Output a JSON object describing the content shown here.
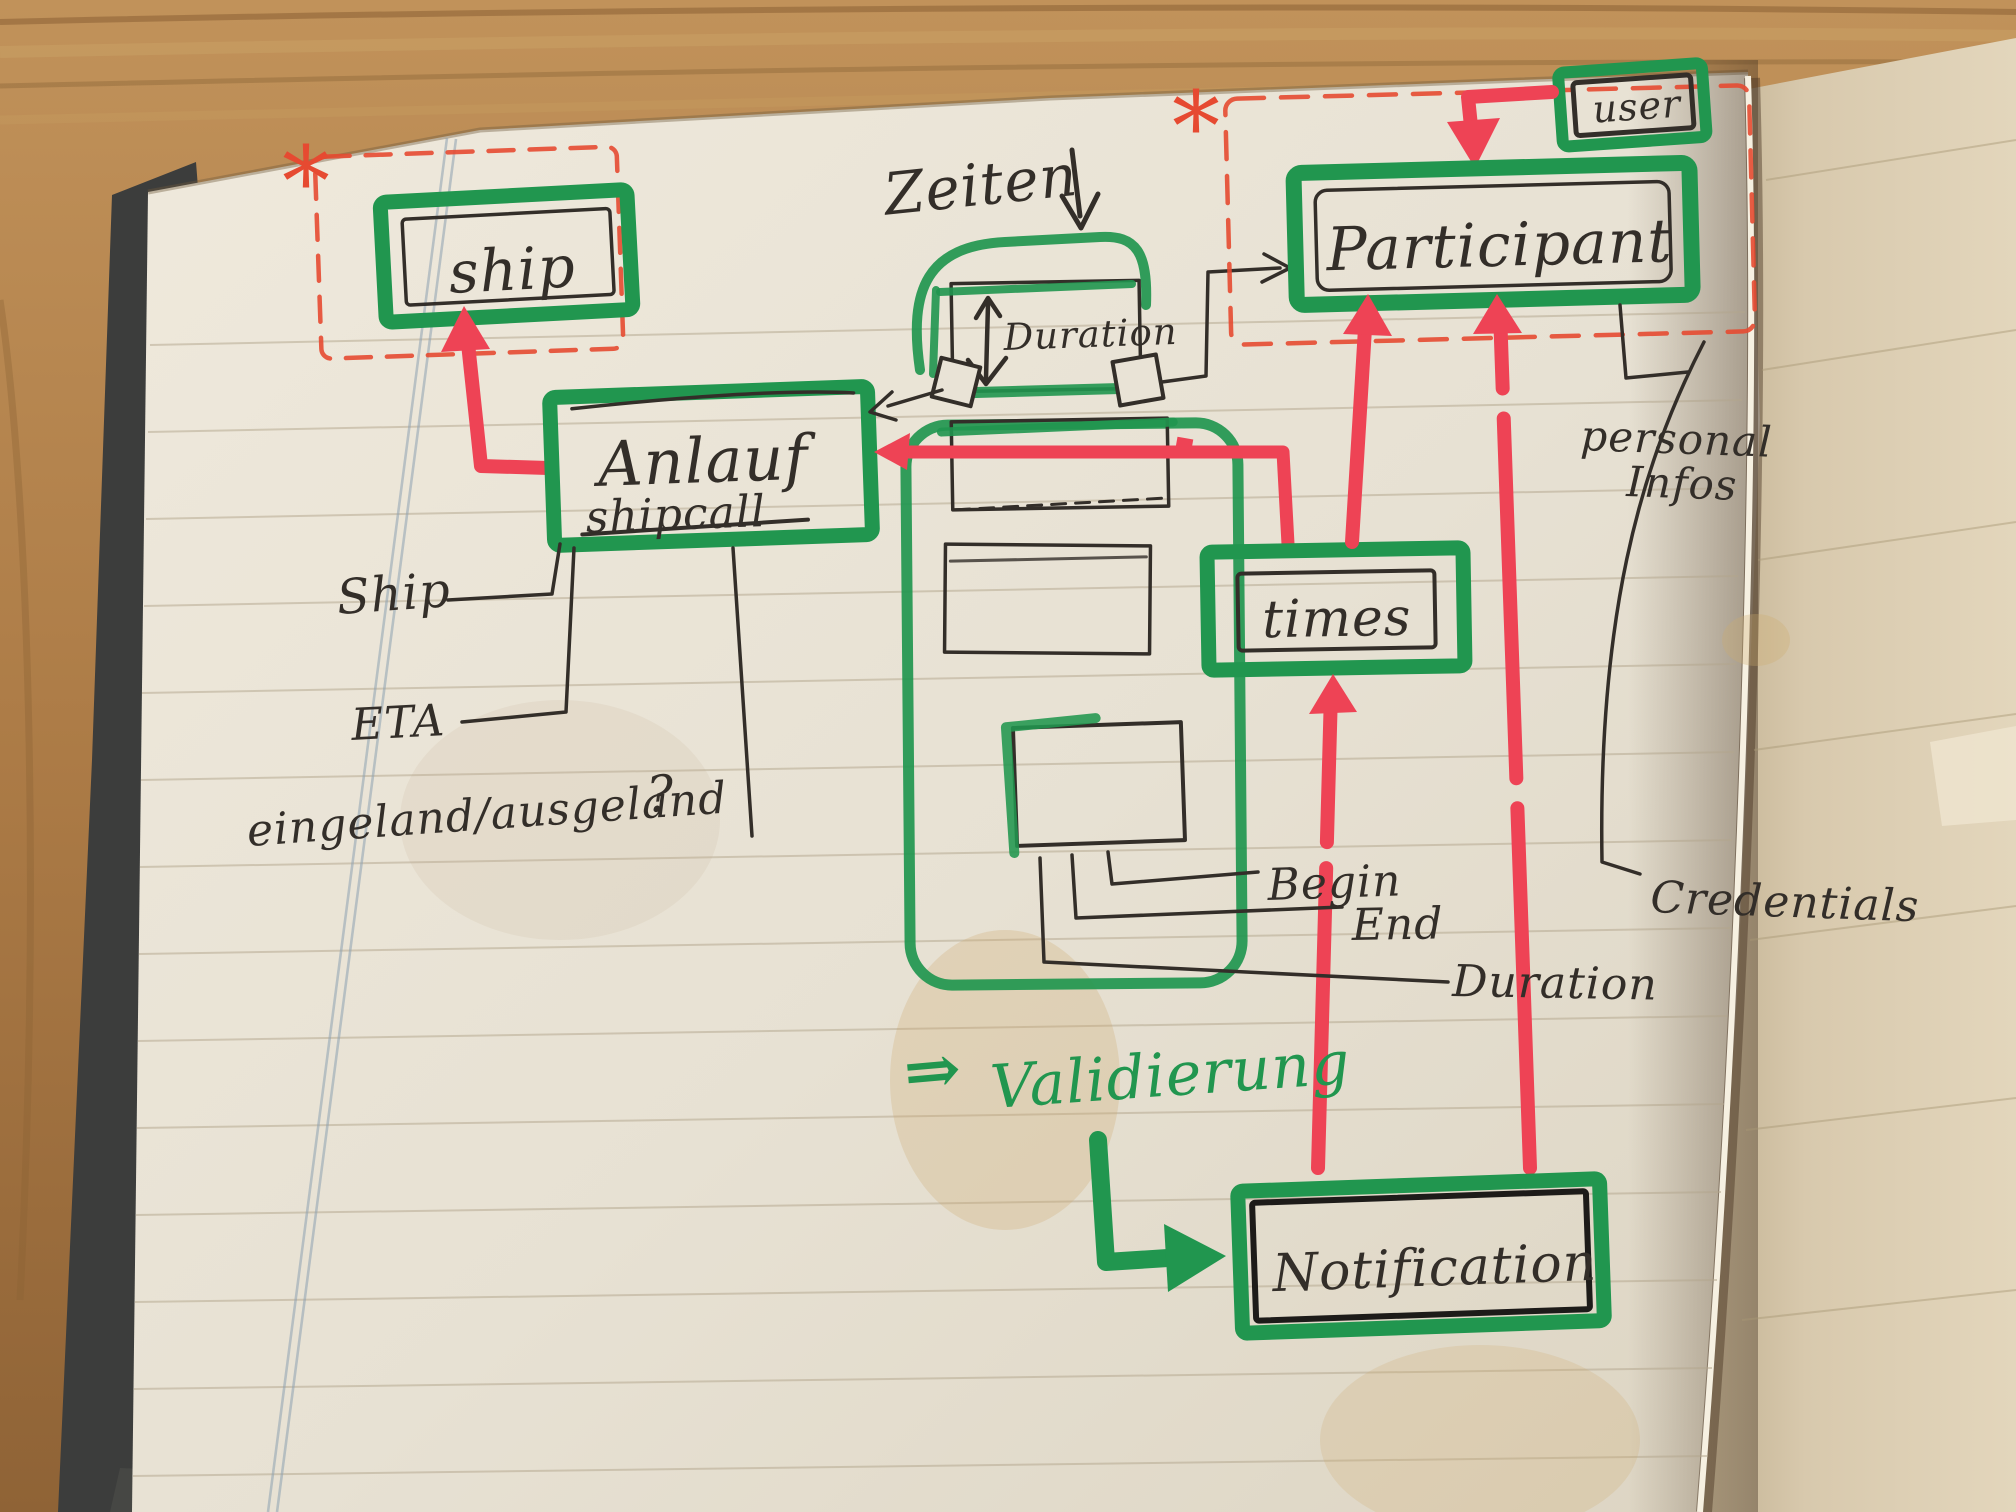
{
  "page": {
    "boxes": {
      "ship": {
        "label": "ship"
      },
      "shipcall": {
        "title": "Anlauf",
        "subtitle": "shipcall"
      },
      "participant": {
        "label": "Participant"
      },
      "user": {
        "label": "user"
      },
      "times": {
        "label": "times"
      },
      "notification": {
        "label": "Notification"
      },
      "duration": {
        "label": "Duration"
      }
    },
    "annotations": {
      "zeiten": "Zeiten",
      "ship_attr": "Ship",
      "eta": "ETA",
      "in_out": "eingeland/ausgeland",
      "question": "?",
      "begin": "Begin",
      "end": "End",
      "duration": "Duration",
      "personal": "personal",
      "infos": "Infos",
      "credentials": "Credentials",
      "validierung_prefix": "⇒",
      "validierung": "Validierung",
      "asterisk_left": "*",
      "asterisk_right": "*"
    },
    "colors": {
      "marker_green": "#21964f",
      "marker_red": "#ee4355",
      "dashed_red": "#e64a31",
      "ink": "#332e29",
      "paper": "#e9e3d6",
      "right_page": "#d8c9ad",
      "wood": "#b08149",
      "cover": "#3c3d3c"
    }
  }
}
